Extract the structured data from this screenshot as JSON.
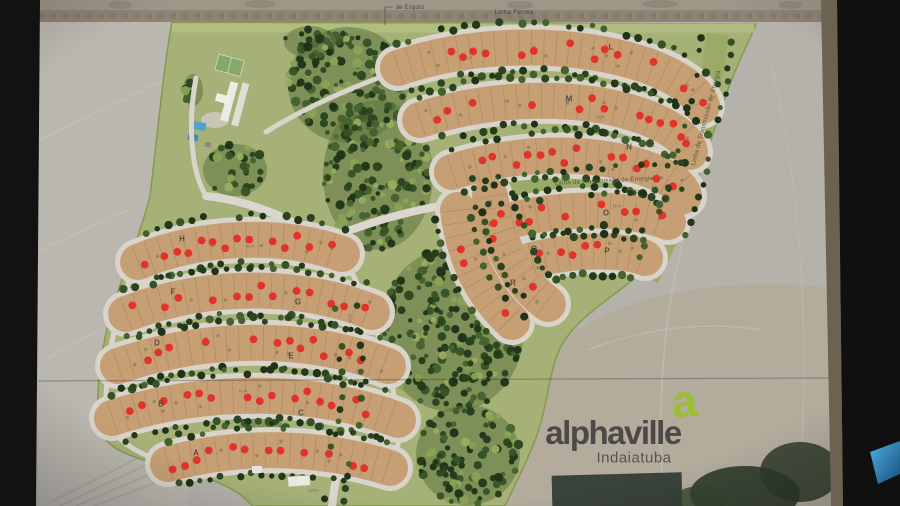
{
  "map": {
    "annotations": {
      "sewage": "de Esgoto",
      "railway": "Linha Férrea",
      "powerline_horizontal": "Linha de Transmissão de Energia",
      "powerline_vertical": "Linha de Transmissão de Energia",
      "support_building": "Apoio"
    },
    "blocks": [
      {
        "letter": "A",
        "x": 196,
        "y": 453
      },
      {
        "letter": "B",
        "x": 161,
        "y": 404
      },
      {
        "letter": "C",
        "x": 301,
        "y": 413
      },
      {
        "letter": "D",
        "x": 157,
        "y": 343
      },
      {
        "letter": "E",
        "x": 291,
        "y": 356
      },
      {
        "letter": "F",
        "x": 173,
        "y": 292
      },
      {
        "letter": "G",
        "x": 298,
        "y": 302
      },
      {
        "letter": "H",
        "x": 182,
        "y": 239
      },
      {
        "letter": "L",
        "x": 611,
        "y": 47
      },
      {
        "letter": "M",
        "x": 569,
        "y": 99
      },
      {
        "letter": "N",
        "x": 629,
        "y": 147
      },
      {
        "letter": "O",
        "x": 606,
        "y": 213
      },
      {
        "letter": "P",
        "x": 607,
        "y": 251
      },
      {
        "letter": "Q",
        "x": 534,
        "y": 249
      },
      {
        "letter": "R",
        "x": 513,
        "y": 283
      }
    ],
    "street_labels": [
      {
        "text": "Rua",
        "x": 600,
        "y": 117,
        "rot": -9
      },
      {
        "text": "Rua",
        "x": 468,
        "y": 58,
        "rot": -16
      },
      {
        "text": "Rua",
        "x": 250,
        "y": 246,
        "rot": -12
      },
      {
        "text": "Rua",
        "x": 350,
        "y": 318,
        "rot": 84
      },
      {
        "text": "Rua",
        "x": 243,
        "y": 391,
        "rot": -12
      },
      {
        "text": "Rua",
        "x": 617,
        "y": 206,
        "rot": -6
      }
    ],
    "logo": {
      "symbol": "a",
      "name": "alphaville",
      "city": "Indaiatuba"
    },
    "colors": {
      "backdrop": "#141413",
      "aerial": "#b5b2ac",
      "development_green": "#a6b177",
      "forest_dark": "#2c441f",
      "lot_tan": "#c79f74",
      "road": "#dbd7d0",
      "sold_lot_dot": "#e13329",
      "street_tree": "#26391d",
      "logo_green": "#9cbe35",
      "logo_gray": "#4c4947"
    }
  }
}
